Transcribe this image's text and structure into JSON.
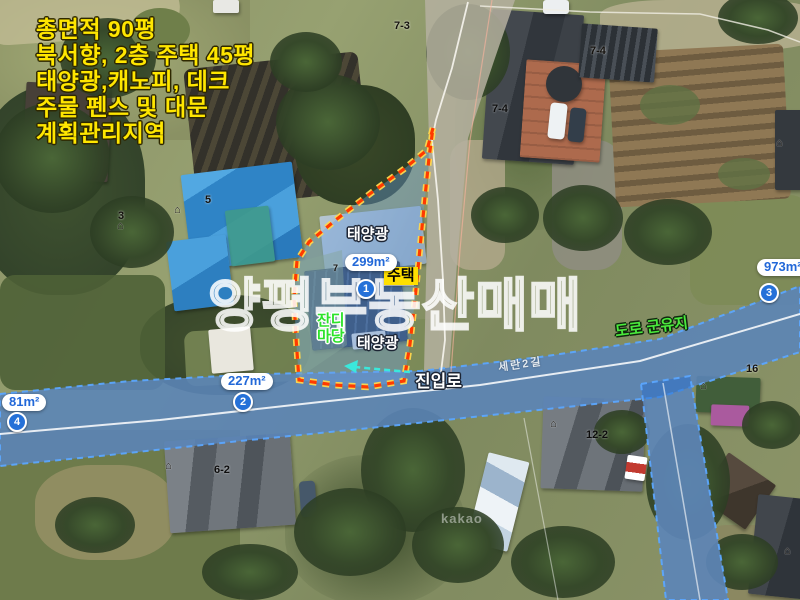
{
  "info_overlay": {
    "lines": [
      "총면적 90평",
      "북서향, 2층 주택 45평",
      "태양광,캐노피, 데크",
      "주물 펜스 및 대문",
      "계획관리지역"
    ]
  },
  "watermark": "양평부동산매매",
  "provider_mark": "kakao",
  "area_markers": [
    {
      "num": "1",
      "area": "299m²"
    },
    {
      "num": "2",
      "area": "227m²"
    },
    {
      "num": "3",
      "area": "973m²"
    },
    {
      "num": "4",
      "area": "81m²"
    }
  ],
  "site_labels": {
    "solar_top": "태양광",
    "solar_bottom": "태양광",
    "house_tag": "주택",
    "lawn_line1": "잔디",
    "lawn_line2": "마당"
  },
  "road_labels": {
    "access_road": "진입로",
    "street_name": "세란2길",
    "county_road": "도로 군유지"
  },
  "parcel_numbers": [
    "3",
    "5",
    "7-3",
    "7-4",
    "7-4",
    "6-2",
    "12-2",
    "16",
    "7"
  ],
  "icons": {
    "house": "⌂"
  },
  "colors": {
    "info_text": "#ffe600",
    "parcel_outline": "#ff3a00",
    "parcel_outline_glow": "#ffd84d",
    "road_highlight": "#2068c8",
    "marker_text": "#2268d8",
    "lawn_text": "#2de32a",
    "county_road_text": "#4ae93c",
    "house_tag_bg": "#ffdf00",
    "watermark_stroke": "#ffffff",
    "direction_arrow": "#3ae8dc"
  }
}
